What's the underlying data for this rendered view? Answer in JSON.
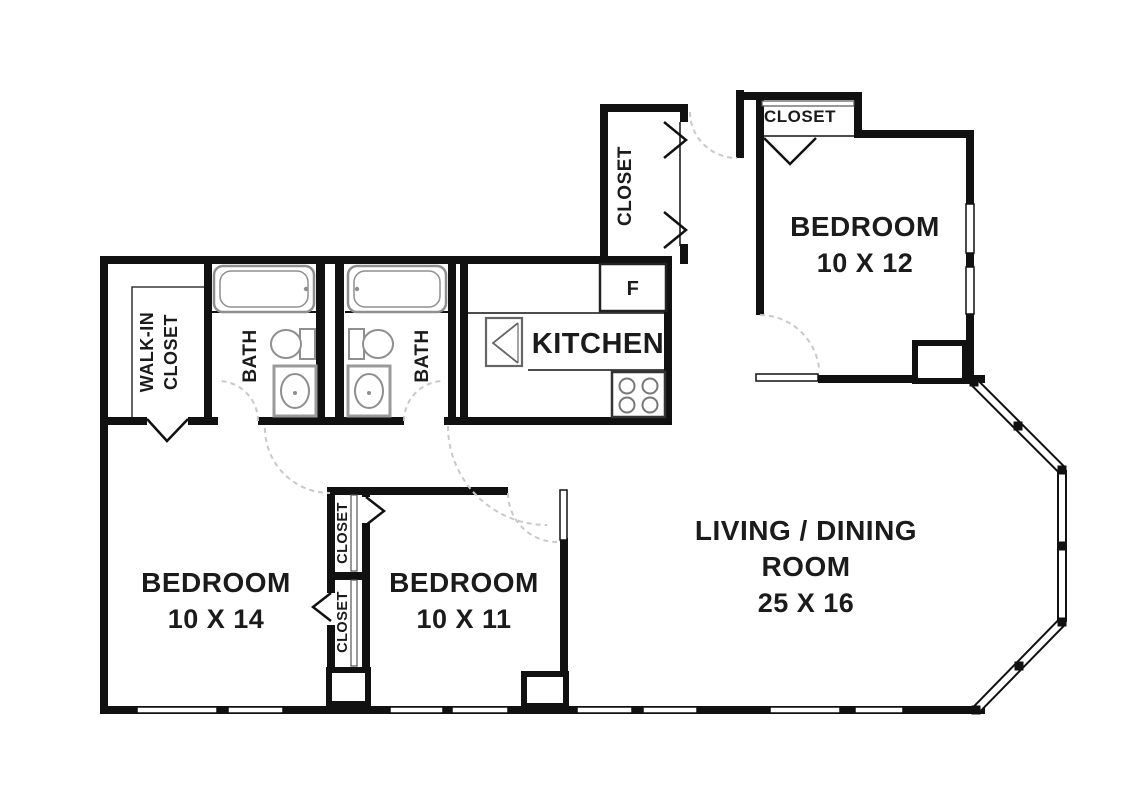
{
  "title": "Apartment floor plan",
  "colors": {
    "wall": "#111111",
    "fixture": "#8f8f8f",
    "door_swing": "#c9c9c9",
    "background": "#ffffff",
    "text": "#1b1b1b"
  },
  "rooms": {
    "bedroom_top_right": {
      "label": "BEDROOM",
      "dims": "10 X 12"
    },
    "bedroom_bottom_left": {
      "label": "BEDROOM",
      "dims": "10 X 14"
    },
    "bedroom_bottom_middle": {
      "label": "BEDROOM",
      "dims": "10 X 11"
    },
    "living_dining": {
      "line1": "LIVING / DINING",
      "line2": "ROOM",
      "dims": "25 X 16"
    },
    "kitchen": {
      "label": "KITCHEN"
    },
    "bath_left": {
      "label": "BATH"
    },
    "bath_right": {
      "label": "BATH"
    },
    "walk_in_closet": {
      "line1": "WALK-IN",
      "line2": "CLOSET"
    },
    "closet_entry_hall": {
      "label": "CLOSET"
    },
    "closet_bedroom_top_right": {
      "label": "CLOSET"
    },
    "closet_middle_upper": {
      "label": "CLOSET"
    },
    "closet_middle_lower": {
      "label": "CLOSET"
    },
    "refrigerator": {
      "label": "F"
    }
  }
}
